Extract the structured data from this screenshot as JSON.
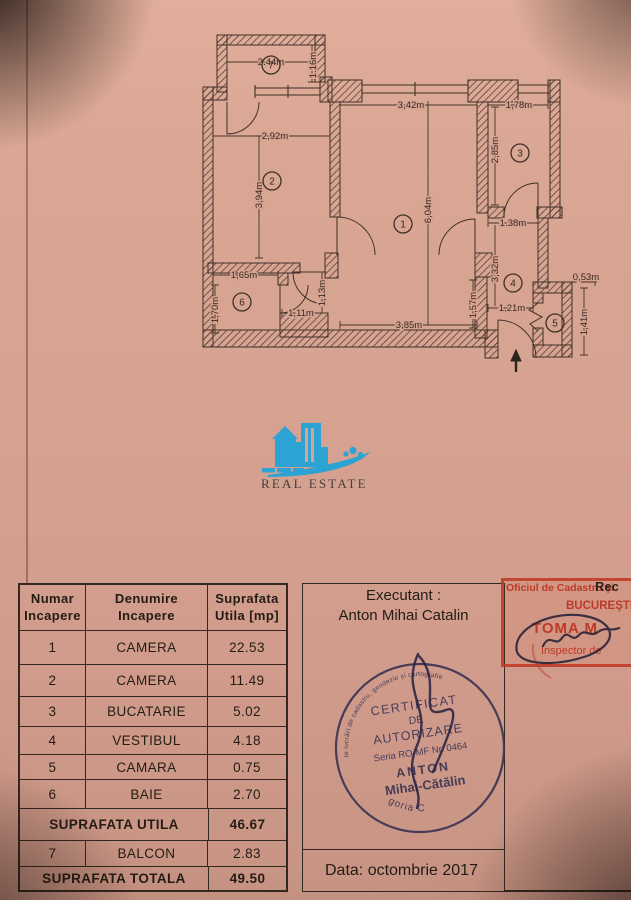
{
  "logo": {
    "title": "REAL ESTATE"
  },
  "plan": {
    "rooms": [
      "1",
      "2",
      "3",
      "4",
      "5",
      "6",
      "7"
    ],
    "dims": {
      "balcony_w": "2.44m",
      "balcony_d": "1.16m",
      "room2_w": "2,92m",
      "room2_h": "3,94m",
      "room1_w": "3,42m",
      "room1_h": "6,04m",
      "room1_w_bottom": "3,85m",
      "room3_w": "1,78m",
      "room3_h": "2,85m",
      "hall_w": "1.38m",
      "hall_h": "3,32m",
      "hall_door": "1,21m",
      "hall_left": "1,57m",
      "pantry_w": "0,53m",
      "pantry_h": "1,41m",
      "bath_w": "1,65m",
      "bath_h": "1,70m",
      "vest_door": "1,11m",
      "vest_w": "1,13m"
    }
  },
  "table": {
    "headers": [
      {
        "l1": "Numar",
        "l2": "Incapere"
      },
      {
        "l1": "Denumire",
        "l2": "Incapere"
      },
      {
        "l1": "Suprafata",
        "l2": "Utila [mp]"
      }
    ],
    "rows": [
      {
        "num": "1",
        "name": "CAMERA",
        "value": "22.53"
      },
      {
        "num": "2",
        "name": "CAMERA",
        "value": "11.49"
      },
      {
        "num": "3",
        "name": "BUCATARIE",
        "value": "5.02"
      },
      {
        "num": "4",
        "name": "VESTIBUL",
        "value": "4.18"
      },
      {
        "num": "5",
        "name": "CAMARA",
        "value": "0.75"
      },
      {
        "num": "6",
        "name": "BAIE",
        "value": "2.70"
      }
    ],
    "subtotal": {
      "label": "SUPRAFATA UTILA",
      "value": "46.67"
    },
    "row7": {
      "num": "7",
      "name": "BALCON",
      "value": "2.83"
    },
    "total": {
      "label": "SUPRAFATA TOTALA",
      "value": "49.50"
    }
  },
  "executant": {
    "label": "Executant :",
    "name": "Anton Mihai Catalin"
  },
  "footer": {
    "date": "Data: octombrie 2017"
  },
  "red_stamp": {
    "line1": "Oficiul de Cadastru şi",
    "line2": "BUCUREŞTI",
    "name": "TOMA M",
    "line4": "Inspector de",
    "black_overlay": "Rec"
  },
  "round_stamp": {
    "ring": "Persoană fizică autorizată de ANCPI să execute lucrări de cadastru, geodezie şi cartografie",
    "l1": "CERTIFICAT",
    "l2": "DE",
    "l3": "AUTORIZARE",
    "serial": "Seria RO-MF Nr. 0464",
    "name1": "ANTON",
    "name2": "Mihai-Cătălin",
    "category": "Categoria C"
  }
}
